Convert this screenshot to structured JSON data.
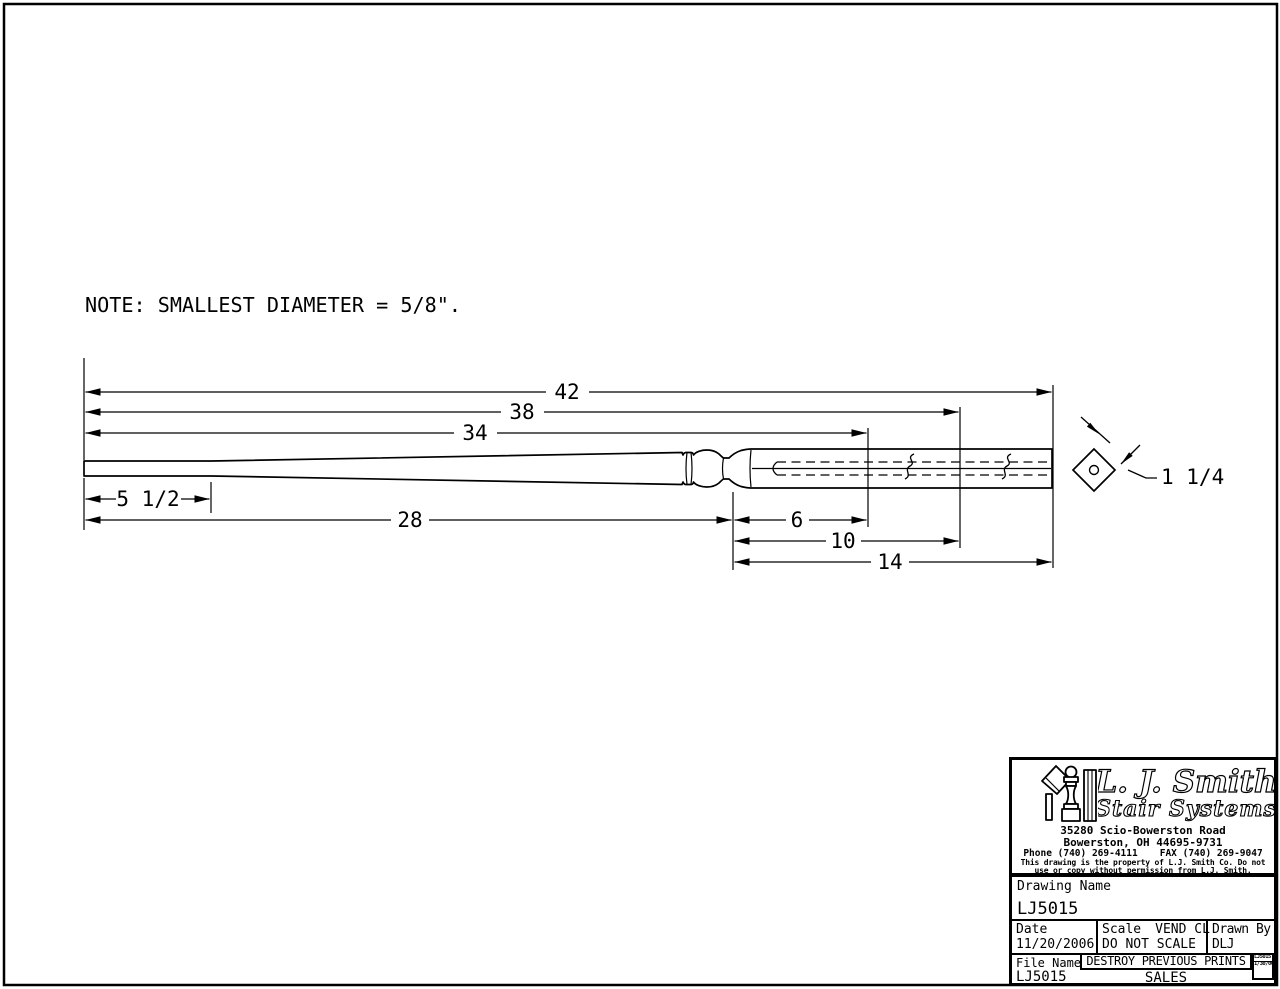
{
  "note": "NOTE: SMALLEST DIAMETER = 5/8\".",
  "dimensions": {
    "overall_length": "42",
    "length_38": "38",
    "length_34": "34",
    "dowel_top": "5 1/2",
    "taper_length": "28",
    "square_6": "6",
    "square_10": "10",
    "square_14": "14",
    "square_width": "1 1/4"
  },
  "title_block": {
    "company": "L. J. Smith",
    "tagline": "Stair Systems",
    "address1": "35280 Scio-Bowerston Road",
    "address2": "Bowerston, OH 44695-9731",
    "phone": "Phone (740) 269-4111",
    "fax": "FAX (740) 269-9047",
    "legal1": "This drawing is the property of L.J. Smith Co. Do not",
    "legal2": "use or copy without permission from L.J. Smith.",
    "drawing_name_label": "Drawing Name",
    "drawing_name": "LJ5015",
    "date_label": "Date",
    "date": "11/20/2006",
    "scale_label": "Scale",
    "scale_value": "VEND CL",
    "scale_note": "DO NOT SCALE",
    "drawn_by_label": "Drawn By",
    "drawn_by": "DLJ",
    "file_name_label": "File Name",
    "file_name": "LJ5015",
    "destroy_note": "DESTROY PREVIOUS PRINTS",
    "sales_note": "SALES",
    "stamp_line1": "LJ5015",
    "stamp_line2": "1/30/06"
  },
  "colors": {
    "ink": "#000000",
    "paper": "#ffffff"
  }
}
